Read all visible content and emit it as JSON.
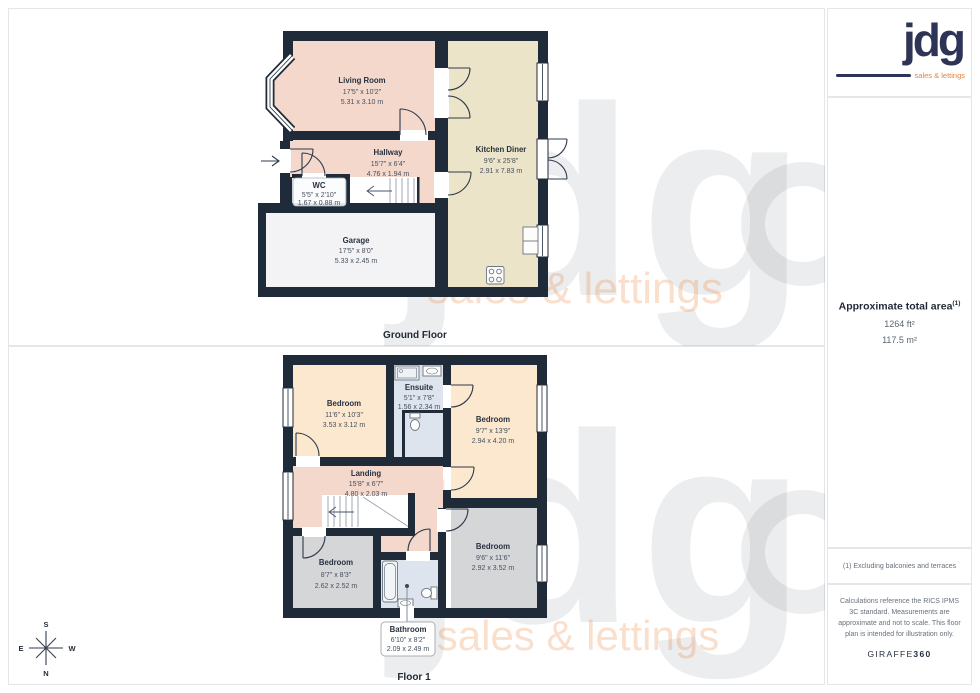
{
  "sidebar": {
    "logo": {
      "brand": "jdg",
      "tagline": "sales & lettings"
    },
    "area": {
      "title": "Approximate total area",
      "sup": "(1)",
      "imperial": "1264 ft²",
      "metric": "117.5 m²"
    },
    "footnote": "(1) Excluding balconies and terraces",
    "disclaimer": "Calculations reference the RICS IPMS 3C standard. Measurements are approximate and not to scale. This floor plan is intended for illustration only.",
    "brand": {
      "name": "GIRAFFE",
      "suffix": "360"
    }
  },
  "ground_floor": {
    "label": "Ground Floor",
    "rooms": {
      "living_room": {
        "name": "Living Room",
        "dims_ft": "17'5\" x 10'2\"",
        "dims_m": "5.31 x 3.10 m"
      },
      "hallway": {
        "name": "Hallway",
        "dims_ft": "15'7\" x 6'4\"",
        "dims_m": "4.76 x 1.94 m"
      },
      "wc": {
        "name": "WC",
        "dims_ft": "5'5\" x 2'10\"",
        "dims_m": "1.67 x 0.88 m"
      },
      "kitchen_diner": {
        "name": "Kitchen Diner",
        "dims_ft": "9'6\" x 25'8\"",
        "dims_m": "2.91 x 7.83 m"
      },
      "garage": {
        "name": "Garage",
        "dims_ft": "17'5\" x 8'0\"",
        "dims_m": "5.33 x 2.45 m"
      }
    }
  },
  "floor_1": {
    "label": "Floor 1",
    "rooms": {
      "bedroom_1": {
        "name": "Bedroom",
        "dims_ft": "11'6\" x 10'3\"",
        "dims_m": "3.53 x 3.12 m"
      },
      "ensuite": {
        "name": "Ensuite",
        "dims_ft": "5'1\" x 7'8\"",
        "dims_m": "1.56 x 2.34 m"
      },
      "bedroom_2": {
        "name": "Bedroom",
        "dims_ft": "9'7\" x 13'9\"",
        "dims_m": "2.94 x 4.20 m"
      },
      "landing": {
        "name": "Landing",
        "dims_ft": "15'8\" x 6'7\"",
        "dims_m": "4.80 x 2.03 m"
      },
      "bedroom_3": {
        "name": "Bedroom",
        "dims_ft": "8'7\" x 8'3\"",
        "dims_m": "2.62 x 2.52 m"
      },
      "bedroom_4": {
        "name": "Bedroom",
        "dims_ft": "9'6\" x 11'6\"",
        "dims_m": "2.92 x 3.52 m"
      },
      "bathroom": {
        "name": "Bathroom",
        "dims_ft": "6'10\" x 8'2\"",
        "dims_m": "2.09 x 2.49 m"
      }
    }
  },
  "compass": {
    "north": "N",
    "south": "S",
    "east": "E",
    "west": "W"
  },
  "watermark": {
    "brand": "jdg",
    "tagline": "sales & lettings"
  },
  "colors": {
    "wall": "#202b3a",
    "room_pink": "#f3d8cb",
    "room_cream": "#fce8ce",
    "room_gray": "#d5d6d8",
    "room_blue": "#dee4ed",
    "room_beige": "#ece4c8",
    "garage": "#f3f3f5",
    "logo_navy": "#2e3456",
    "logo_orange": "#e8823c"
  }
}
